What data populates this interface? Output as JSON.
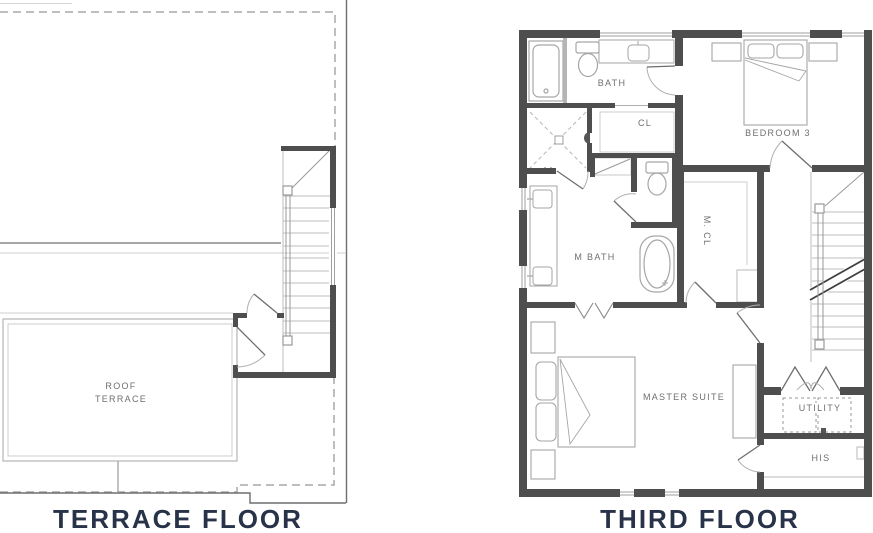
{
  "colors": {
    "wall": "#4e4e4e",
    "medium_line": "#8a8a8a",
    "fixture_line": "#a6a6a6",
    "light_line": "#c9c9c9",
    "dashed_roof_line": "#a8a8a8",
    "room_label": "#6f6f6f",
    "floor_title": "#283349"
  },
  "plans": {
    "terrace": {
      "title": "TERRACE FLOOR",
      "labels": {
        "roof_terrace_line1": "ROOF",
        "roof_terrace_line2": "TERRACE"
      }
    },
    "third": {
      "title": "THIRD FLOOR",
      "labels": {
        "bath": "BATH",
        "closet": "CL",
        "bedroom3": "BEDROOM 3",
        "master_bath": "M BATH",
        "master_closet": "M. CL",
        "master_suite": "MASTER SUITE",
        "utility": "UTILITY",
        "his_closet": "HIS"
      }
    }
  }
}
